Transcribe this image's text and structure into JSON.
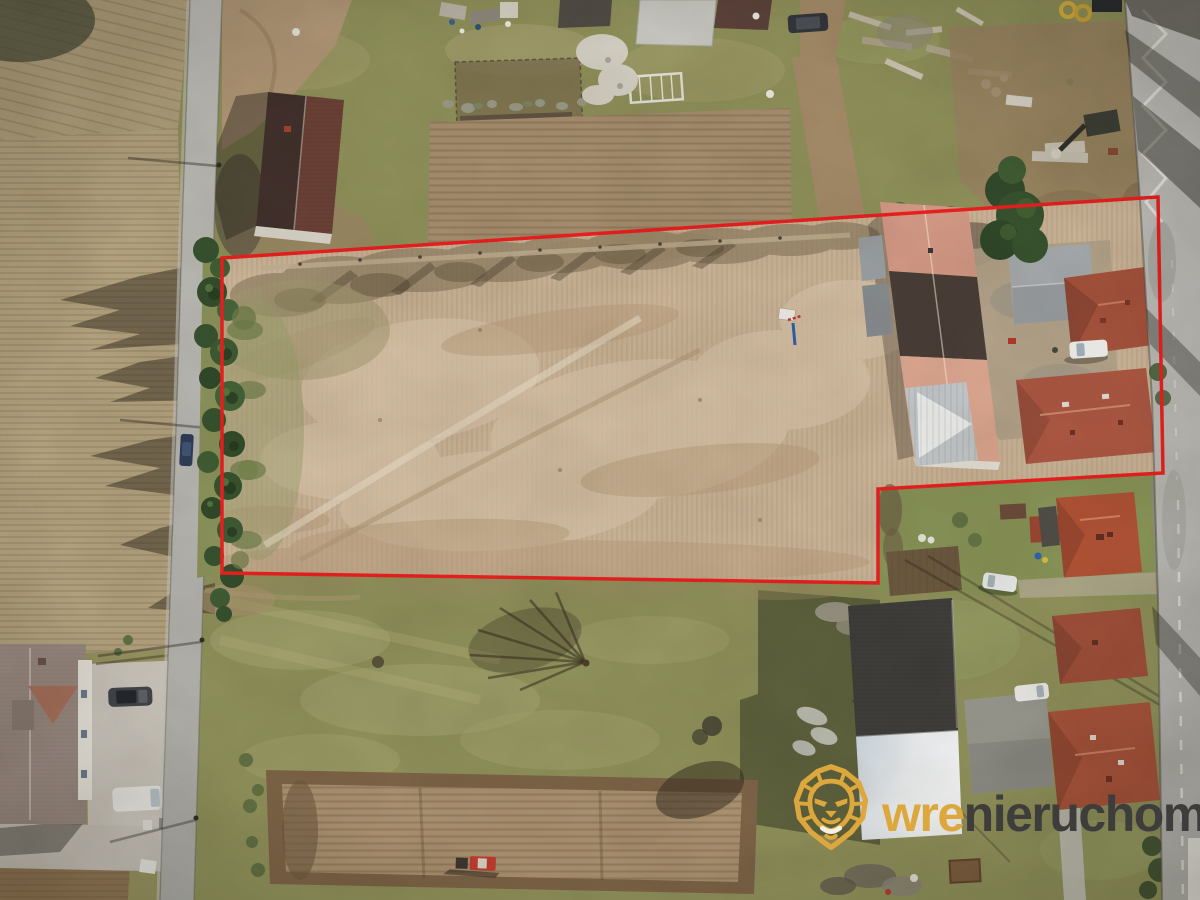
{
  "watermark": {
    "brand_bold": "wre",
    "brand_rest": "nieruchomości",
    "gold": "#DCA83E",
    "mouth_white": "#F6F1E2",
    "dark": "#3E3D3B",
    "lion_icon": "lion-logo-icon"
  },
  "boundary": {
    "color": "#EE1B1B",
    "stroke_width": 3.5,
    "points": [
      [
        222,
        258
      ],
      [
        1158,
        197
      ],
      [
        1163,
        473
      ],
      [
        878,
        489
      ],
      [
        878,
        583
      ],
      [
        222,
        573
      ]
    ]
  },
  "palette": {
    "plot_field": "#CDB69A",
    "grass": "#8F9159",
    "south_grass": "#8D9A5C",
    "stubble_field": "#B5A480",
    "plowed_dark": "#7C6245",
    "road": "#BCBCB8",
    "conifer": "#33502B",
    "roof_salmon": "#D69A86",
    "roof_dark_section": "#463A34",
    "roof_red": "#A85138",
    "roof_gray": "#A7ACB1",
    "roof_taupe": "#9A8B82",
    "white_wall": "#DDE4EA",
    "tractor_red": "#C0392B"
  }
}
